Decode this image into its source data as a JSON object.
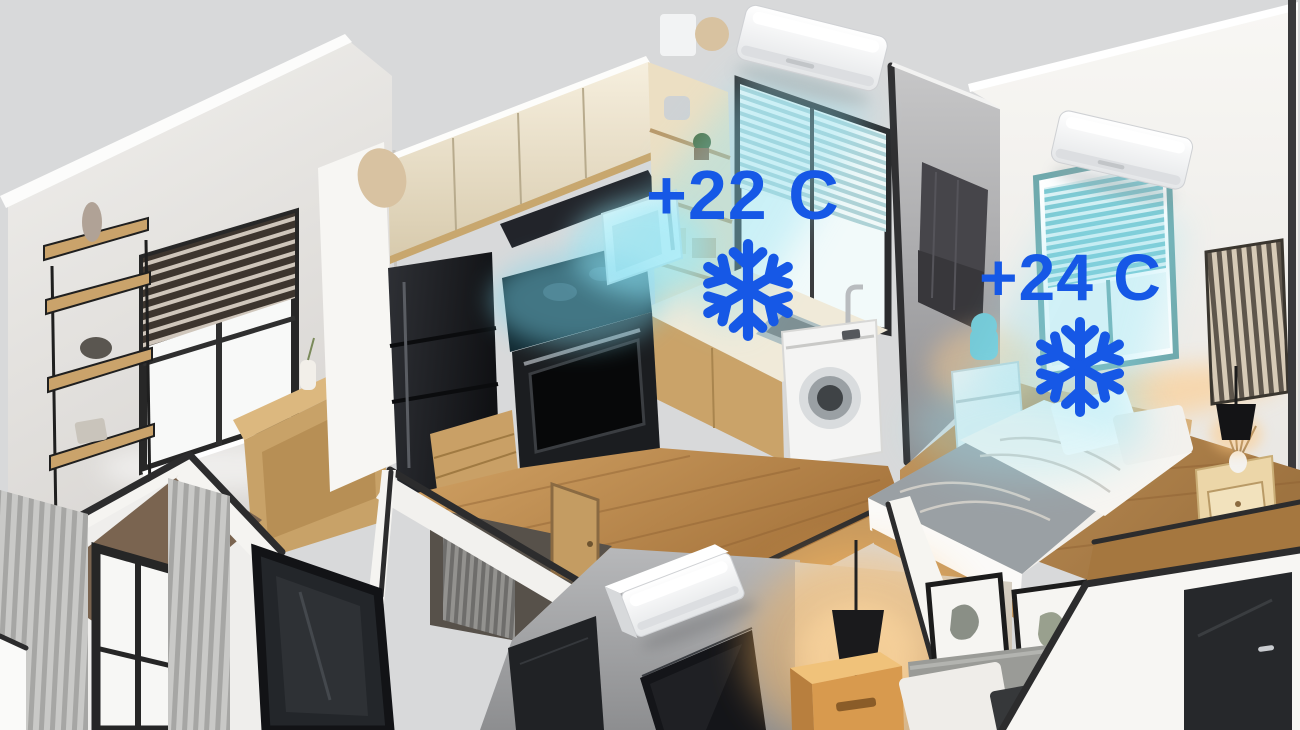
{
  "title": "Isometric apartment cutaway illustration with room cooling",
  "palette": {
    "background": "#d8d9da",
    "annotation_blue": "#1658e6",
    "cool_glow": "#9ce1f1",
    "warm_glow": "#ffbe78",
    "wall_white": "#f5f4f1",
    "wall_gray": "#a7a8aa",
    "wood": "#bd8c54",
    "trim_dark": "#2c2c2d"
  },
  "annotations": {
    "kitchen": {
      "temperature": "+22 C",
      "icon": "snowflake-icon"
    },
    "bedroom": {
      "temperature": "+24 C",
      "icon": "snowflake-icon"
    }
  },
  "devices": {
    "air_conditioners": [
      {
        "id": "kitchen-ac",
        "mounted_on": "kitchen back wall"
      },
      {
        "id": "bedroom-ac",
        "mounted_on": "bedroom back wall"
      },
      {
        "id": "living-room-ac",
        "mounted_on": "living room wall"
      }
    ]
  },
  "rooms": [
    "study",
    "kitchen",
    "bedroom",
    "hallway",
    "bathroom",
    "living-room"
  ]
}
